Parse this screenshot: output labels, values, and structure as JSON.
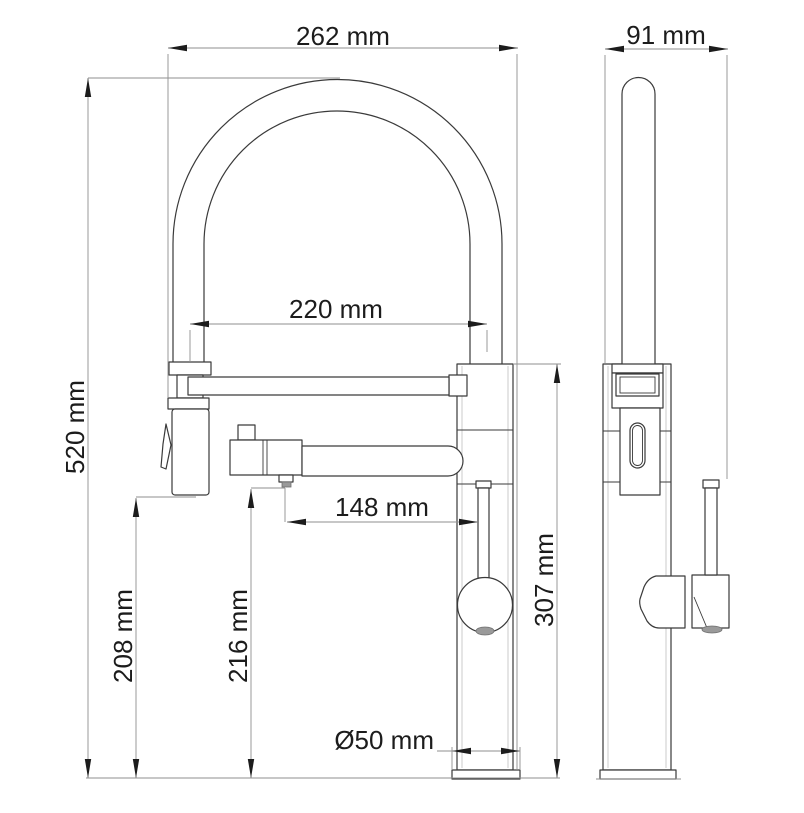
{
  "dim_labels": {
    "overall_width": "262 mm",
    "side_width": "91 mm",
    "hose_span": "220 mm",
    "overall_height": "520 mm",
    "spout_reach": "148 mm",
    "body_height": "307 mm",
    "spray_head_height": "208 mm",
    "spout_height": "216 mm",
    "base_diameter": "Ø50 mm"
  },
  "colors": {
    "background": "#ffffff",
    "object_line": "#3a3a3a",
    "dimension_line": "#8f8f8f",
    "text": "#1c1c1c",
    "shading": "#9a9a9a"
  }
}
